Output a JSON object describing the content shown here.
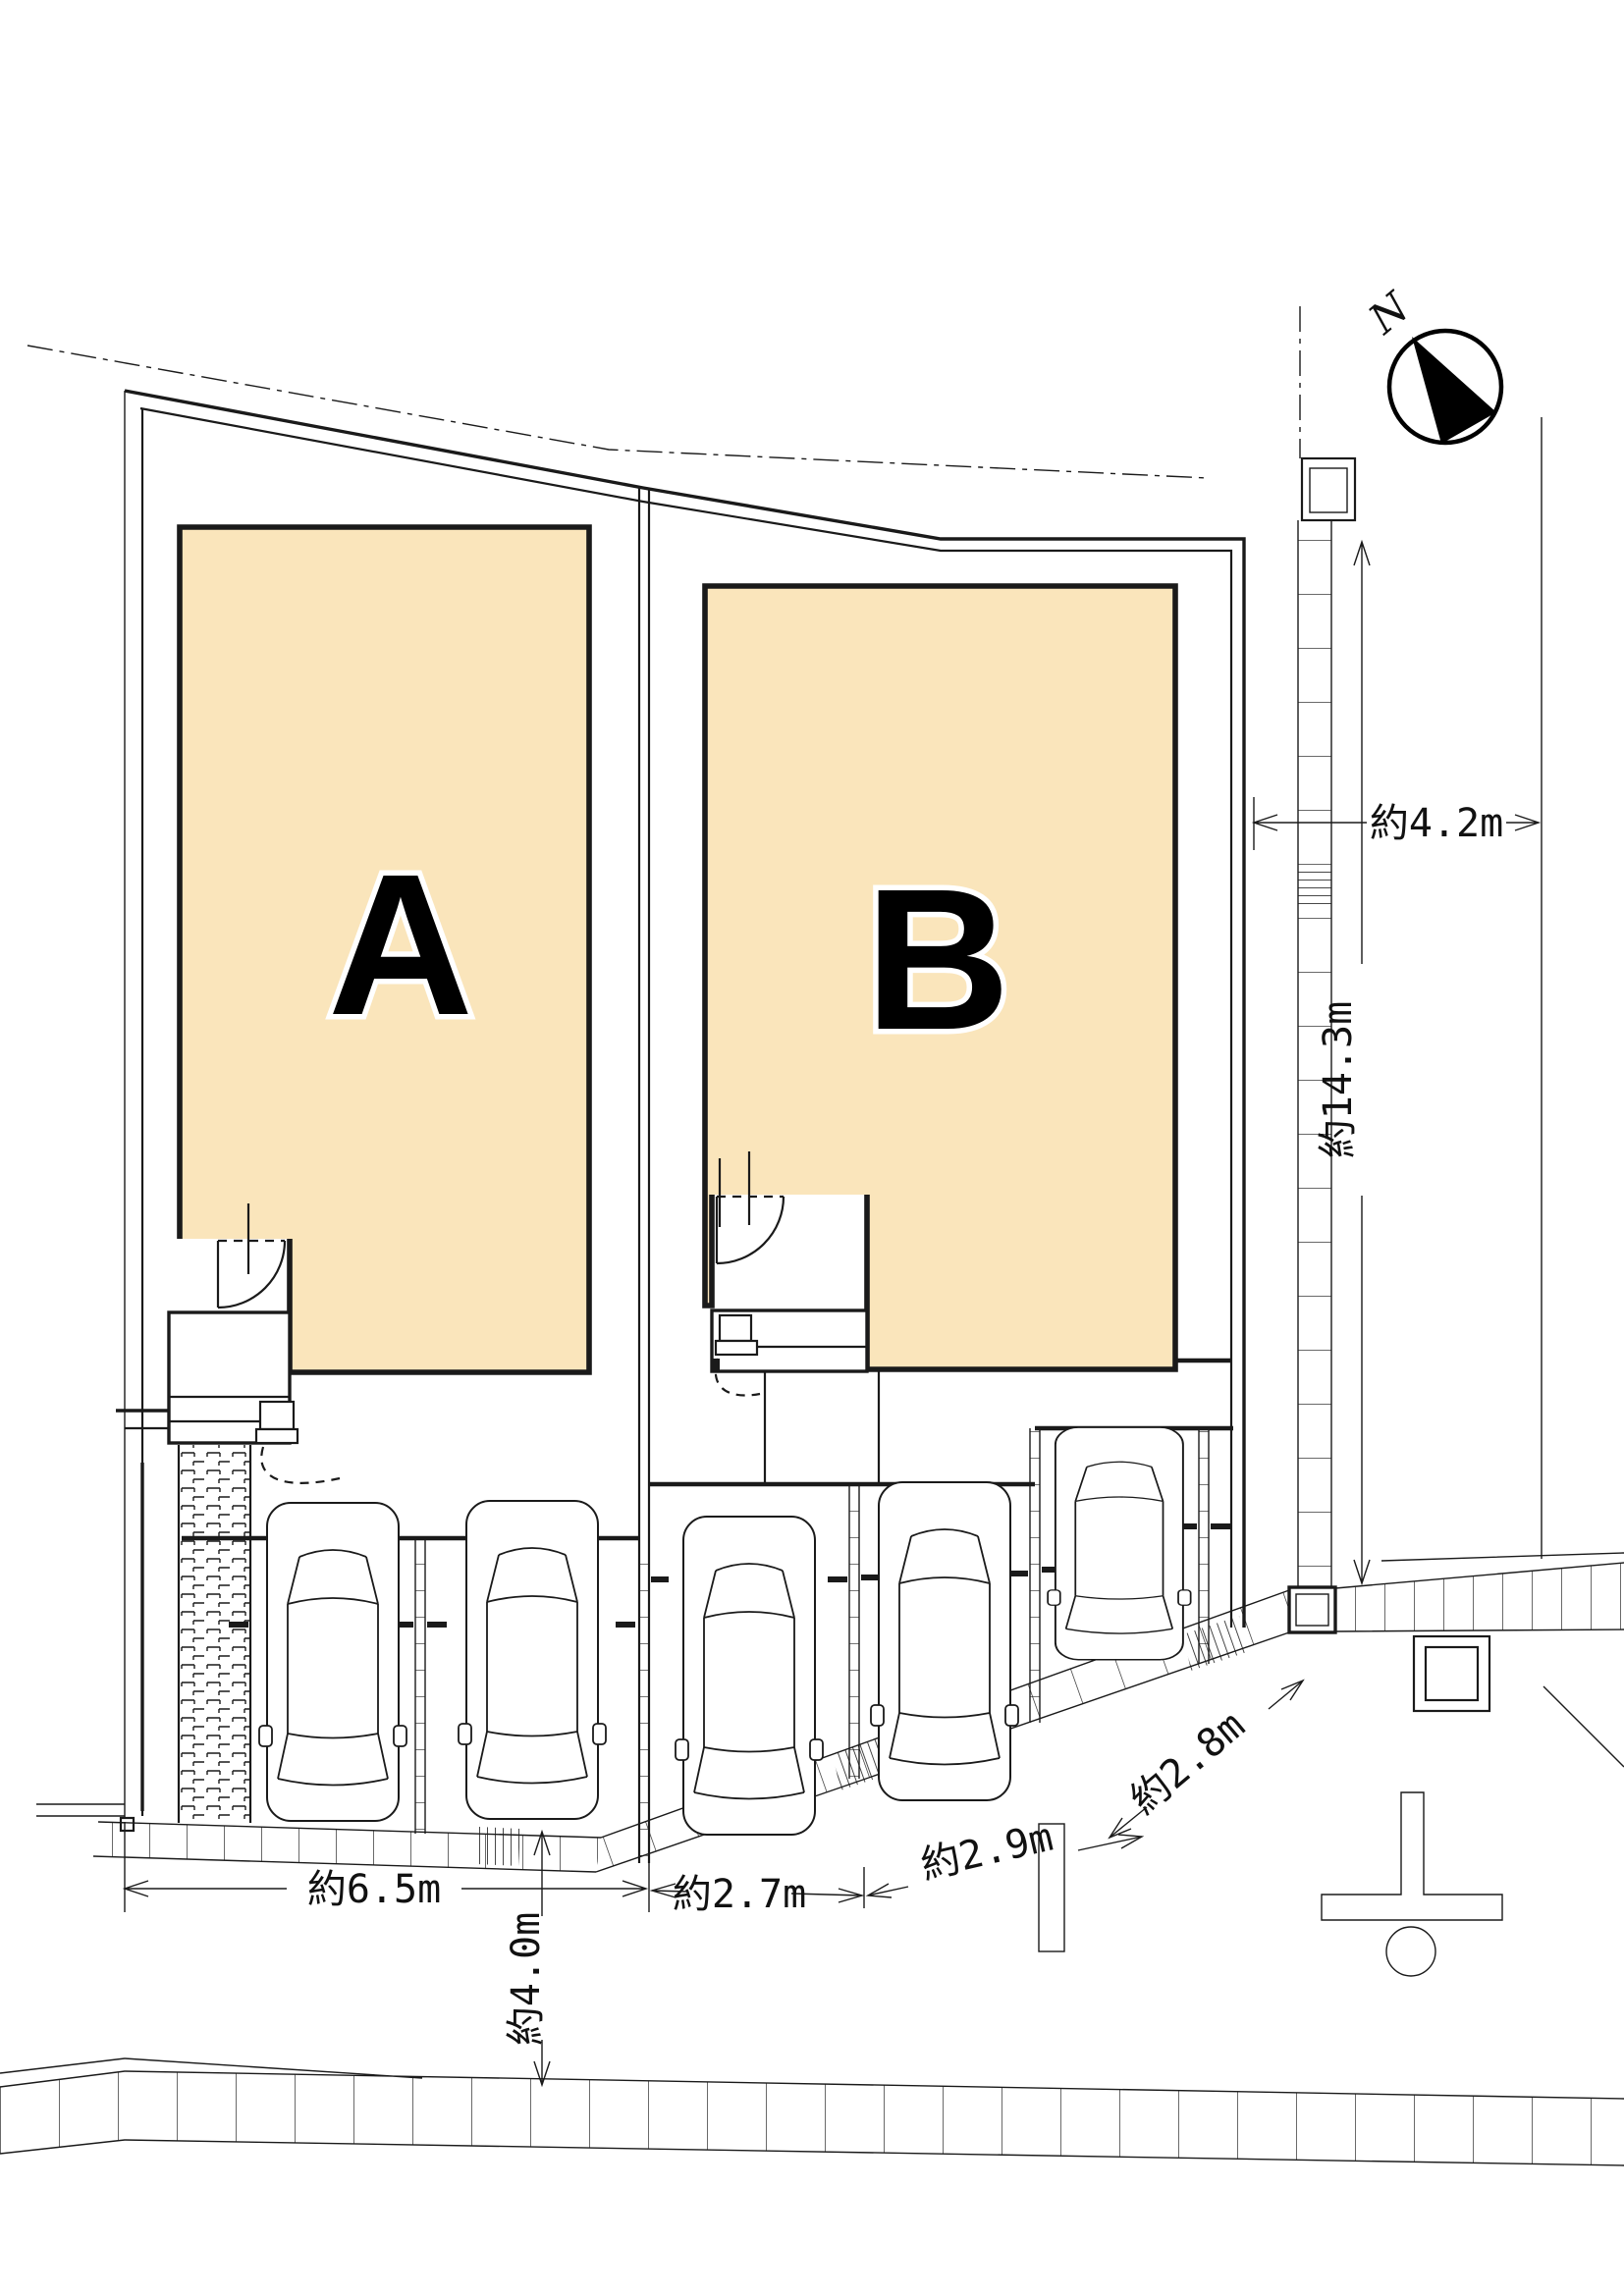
{
  "drawing_type": "site-plan",
  "labels": {
    "lot_a": "A",
    "lot_b": "B",
    "north": "N"
  },
  "dims": {
    "front_road_west": "約6.5m",
    "front_road_mid": "約2.7m",
    "front_road_slant": "約2.9m",
    "front_road_diag": "約2.8m",
    "road_width_south": "約4.0m",
    "road_width_east": "約4.2m",
    "east_side_length": "約14.3m"
  },
  "colors": {
    "bld": "#FAE5BB",
    "line": "#1A1A1A",
    "background": "#FFFFFF"
  },
  "icons": {
    "north_compass": "circle-with-black-needle",
    "car": "plan-view-car-outline",
    "catch_basin": "square-in-square",
    "power_pole": "t-shape-with-circle",
    "walkway": "brick-hatch-strip"
  }
}
